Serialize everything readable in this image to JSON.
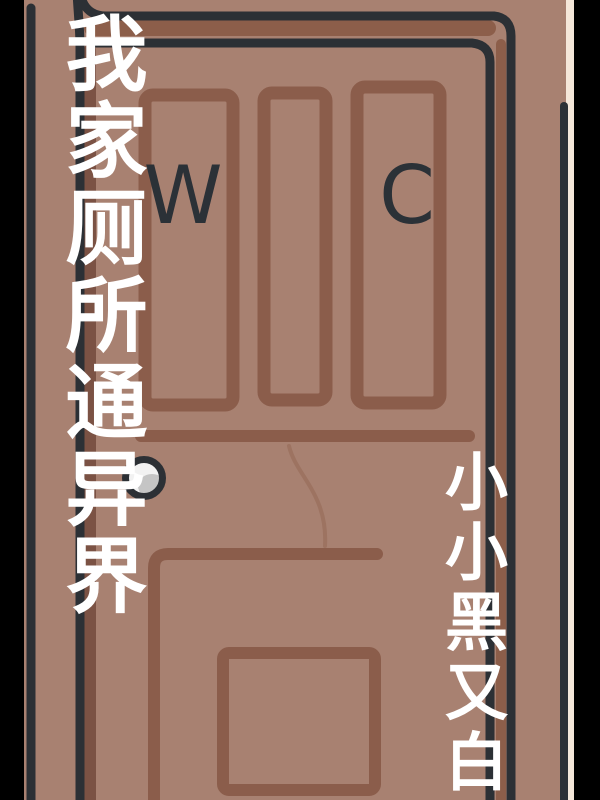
{
  "cover": {
    "title": {
      "text": "我家厕所通异界",
      "orientation": "vertical",
      "color": "#ffffff"
    },
    "author": {
      "text": "小小黑又白",
      "orientation": "vertical",
      "color": "#ffffff"
    },
    "door_letters": {
      "w": "W",
      "c": "C",
      "color": "#2b3137"
    }
  },
  "illustration": {
    "subject": "cartoon-panel-door-with-wc-letters",
    "handle": "round-door-knob-left-side"
  },
  "palette": {
    "background_black": "#000000",
    "wall_and_door_face": "#a88171",
    "frame_brown": "#8c5e4a",
    "left_jamb_brown": "#7b5244",
    "panel_line_brown": "#8b5d4b",
    "scratch_brown": "#936854",
    "dark_outline": "#2c3035",
    "page_edge_cream": "#f5e8da",
    "knob_white": "#f2f2f2",
    "knob_gray": "#c5c5c5"
  }
}
